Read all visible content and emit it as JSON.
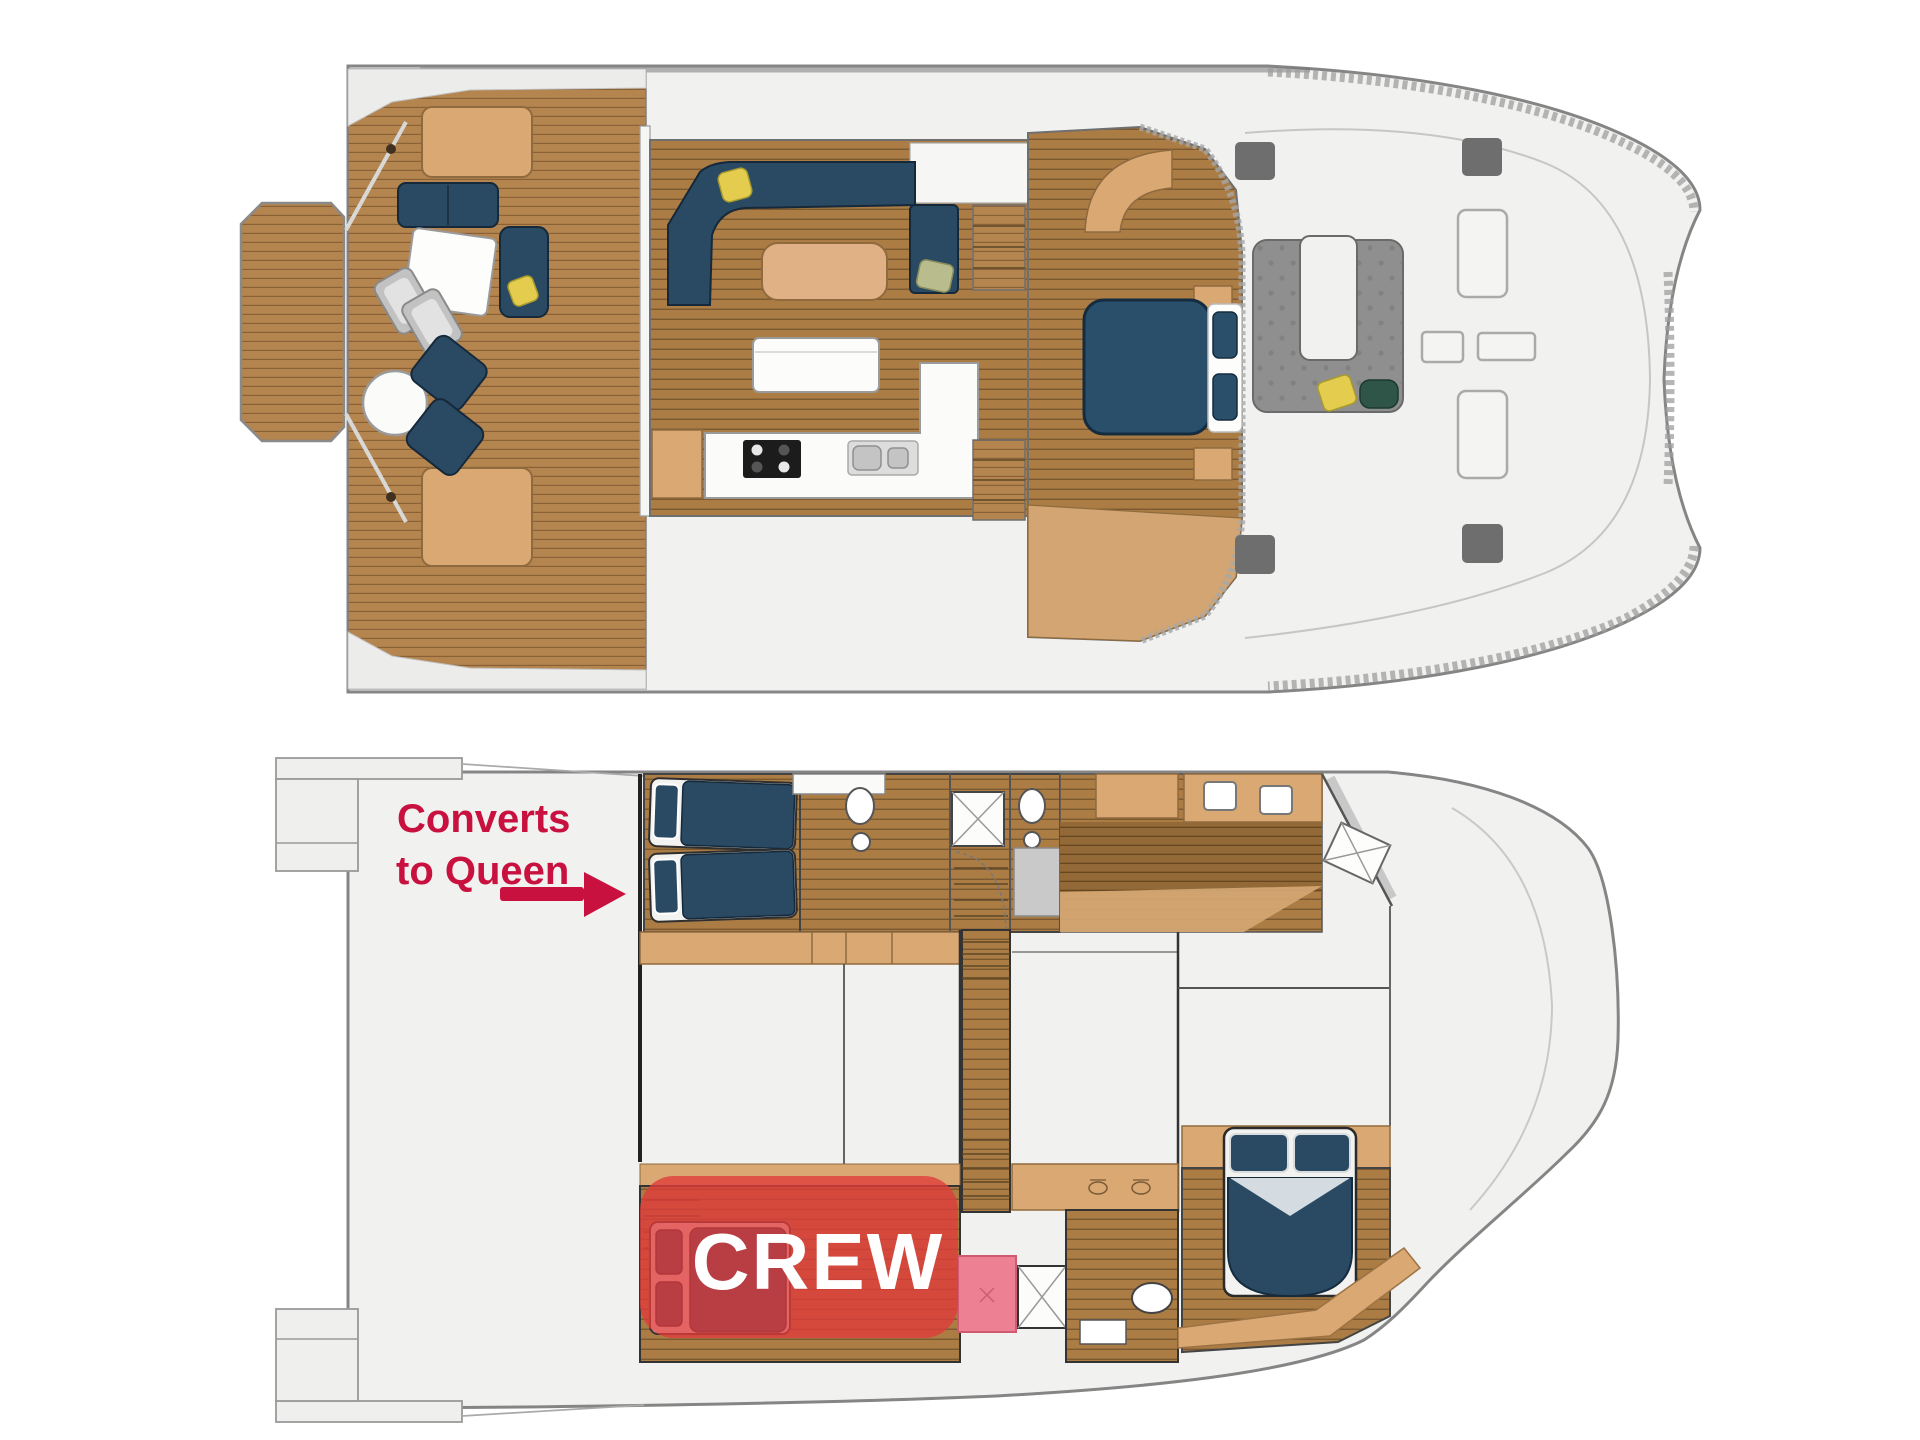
{
  "annotations": {
    "converts_line1": "Converts",
    "converts_line2": "to Queen",
    "crew_label": "CREW"
  },
  "colors": {
    "annotation_red": "#c8113f",
    "crew_overlay_red": "#e03b3b",
    "crew_text": "#ffffff",
    "highlight_pink": "#ee8093",
    "teak_deck": "#b5854f",
    "interior_wood": "#ab7d45",
    "furniture_navy": "#2a4a63",
    "furniture_tan": "#d9a873",
    "hull_fill": "#f1f1f0",
    "hull_outline": "#858585",
    "hatch_gray": "#6e6e6e",
    "cockpit_seat_gray": "#8f8f8f"
  }
}
